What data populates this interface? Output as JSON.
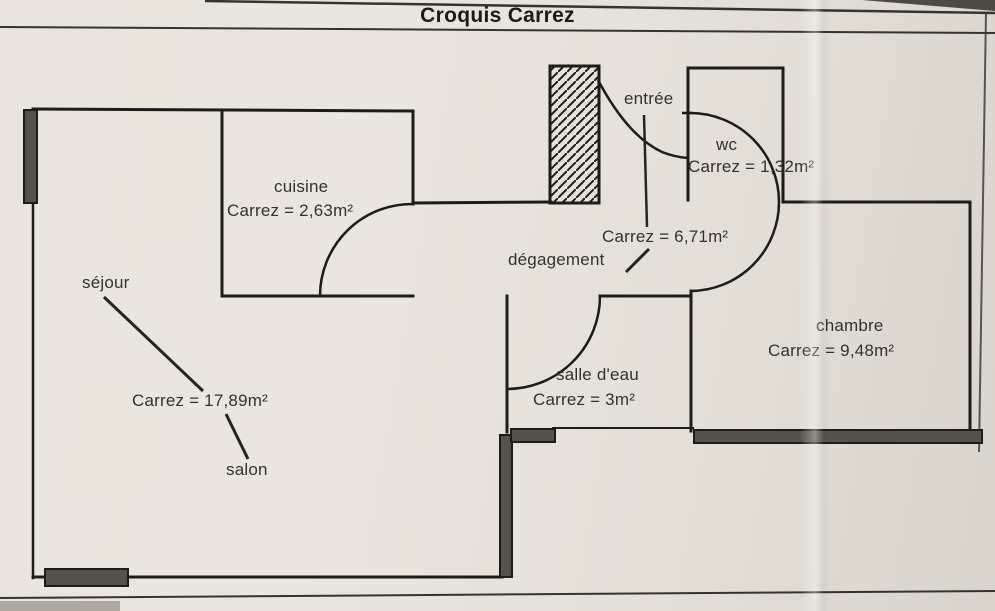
{
  "title": "Croquis Carrez",
  "rooms": {
    "cuisine": {
      "label": "cuisine",
      "carrez": "Carrez = 2,63m²"
    },
    "sejour": {
      "label": "séjour",
      "carrez": "Carrez = 17,89m²",
      "sublabel": "salon"
    },
    "entree": {
      "label": "entrée"
    },
    "wc": {
      "label": "wc",
      "carrez": "Carrez = 1,32m²"
    },
    "degagement": {
      "label": "dégagement",
      "carrez": "Carrez = 6,71m²"
    },
    "salle_deau": {
      "label": "salle d'eau",
      "carrez": "Carrez = 3m²"
    },
    "chambre": {
      "label": "chambre",
      "carrez": "Carrez = 9,48m²"
    }
  },
  "colors": {
    "paper": "#e7e3dc",
    "wall_line": "#1d1c1a",
    "window_bar_fill": "#55514b",
    "page_edge": "#4e4a43"
  }
}
